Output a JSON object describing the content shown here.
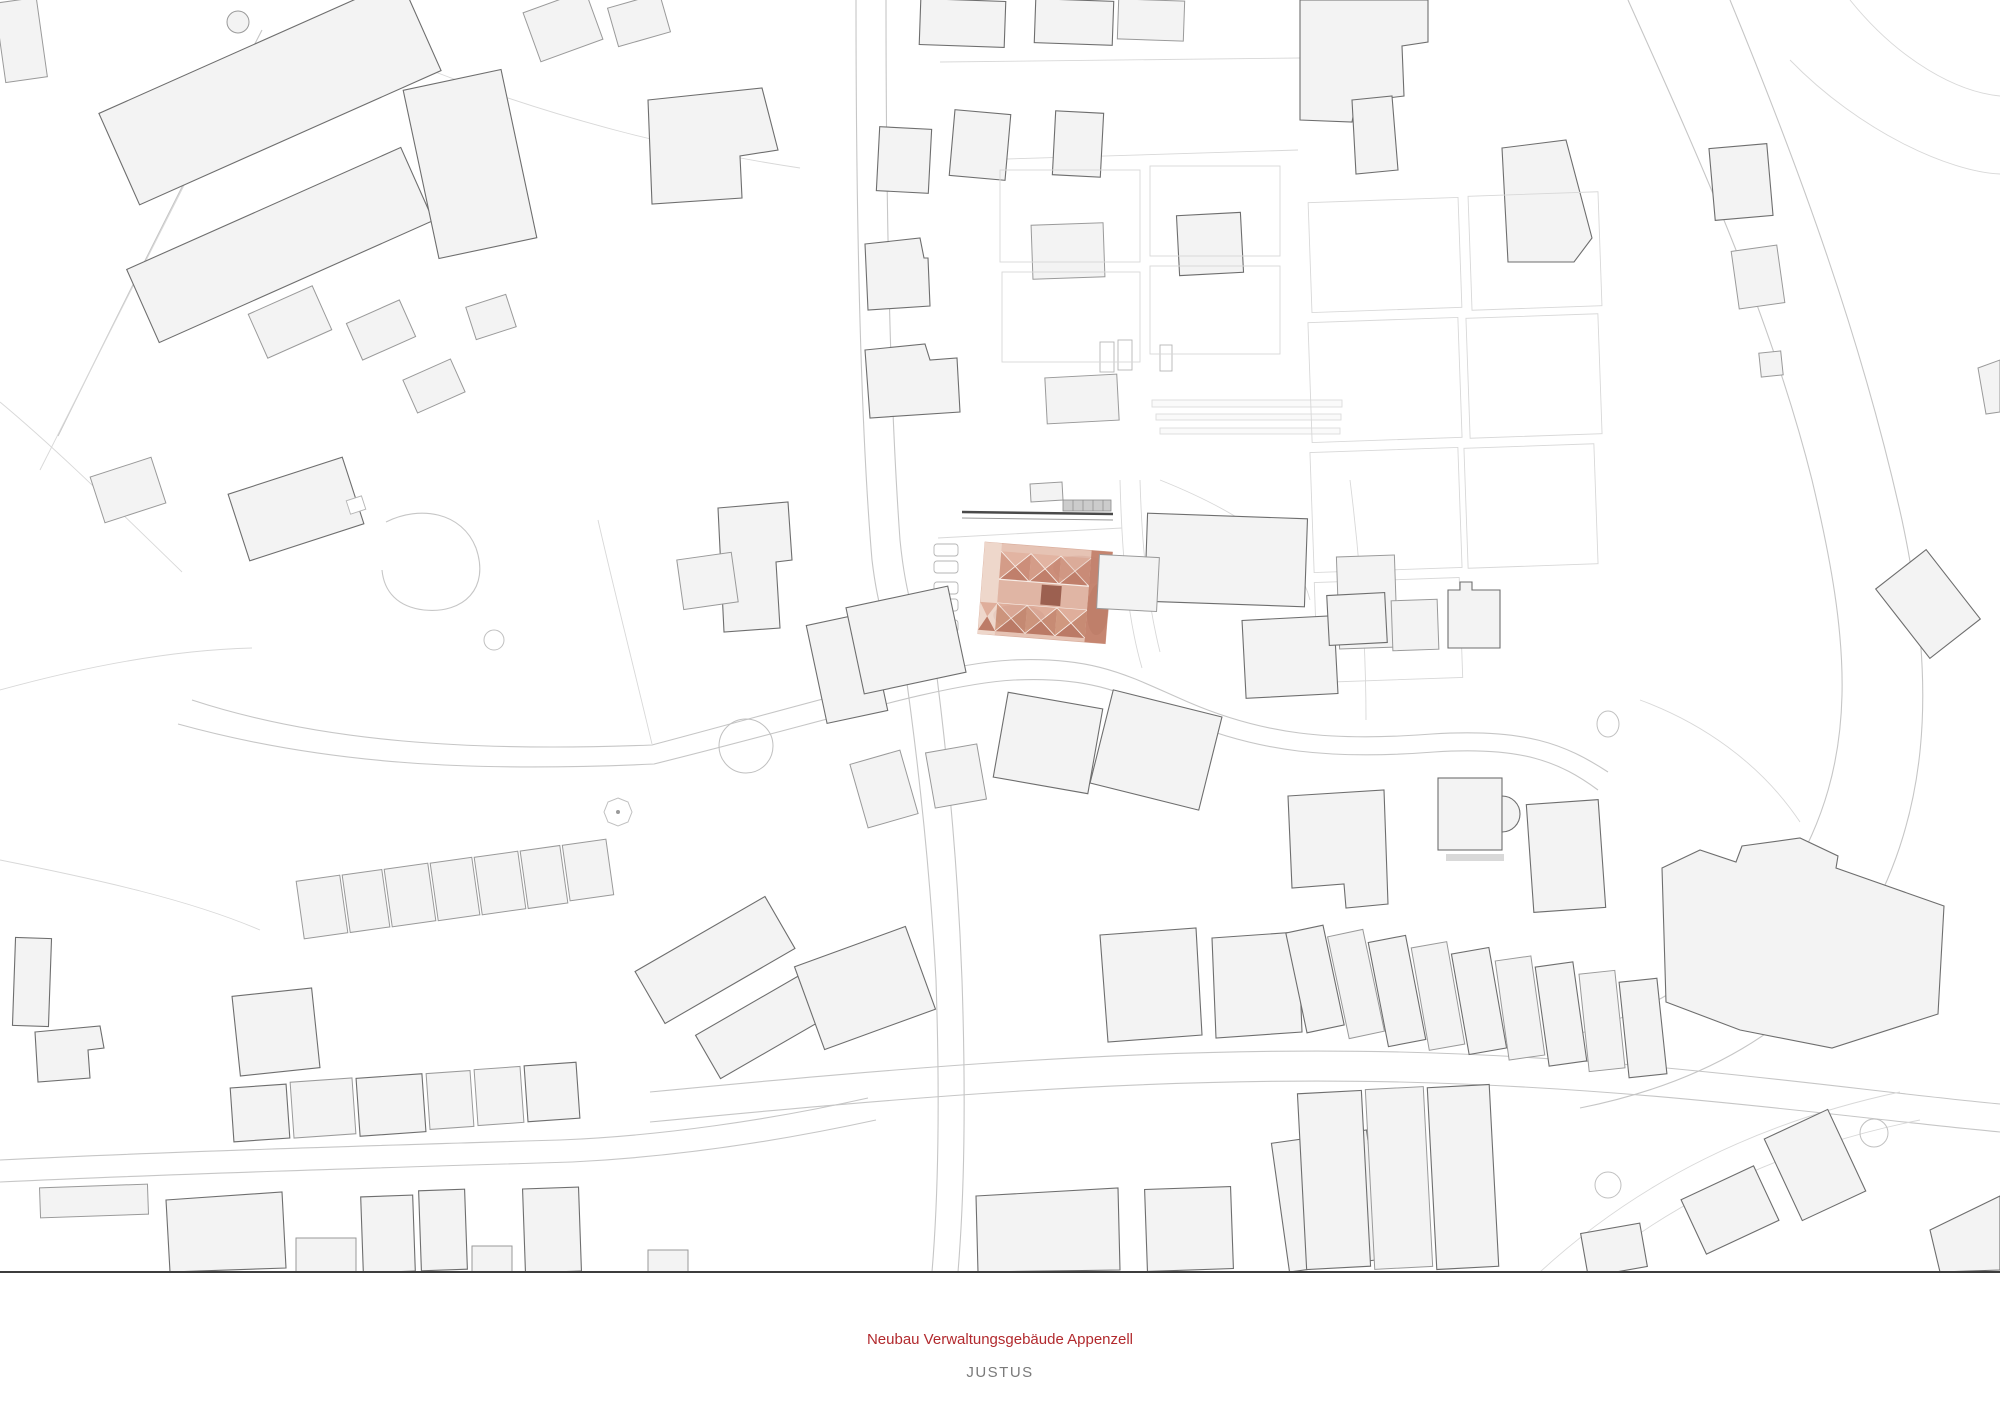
{
  "titles": {
    "project": "Neubau Verwaltungsgebäude Appenzell",
    "author": "JUSTUS"
  },
  "colors": {
    "title_red": "#b22a2e",
    "author_gray": "#7a7a7a",
    "ground_line": "#3c3c3c",
    "highlight_base": "#e6c3b4",
    "highlight_light": "#eed7cb",
    "highlight_mid": "#cf9181",
    "highlight_dark": "#c58570",
    "highlight_core": "#9c6050",
    "building_fill": "#f3f3f3",
    "building_outline": "#9a9a9a"
  }
}
